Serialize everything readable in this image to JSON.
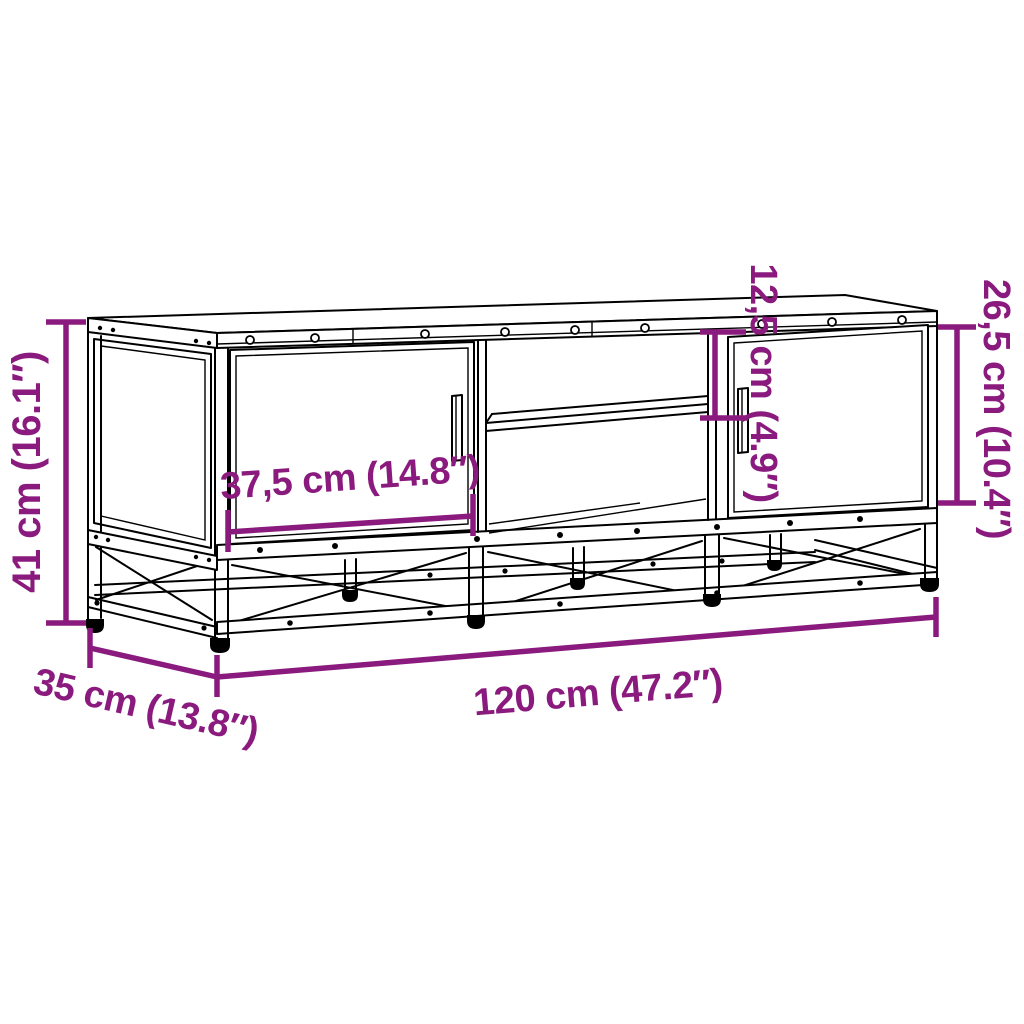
{
  "diagram": {
    "type": "furniture-dimension-diagram",
    "colors": {
      "dimension_accent": "#8A1A7D",
      "drawing_line": "#000000",
      "background": "#FFFFFF"
    },
    "dimensions": {
      "height": "41 cm (16.1″)",
      "depth": "35 cm (13.8″)",
      "width": "120 cm (47.2″)",
      "door_width": "37,5 cm (14.8″)",
      "compartment_height": "12,5 cm (4.9″)",
      "door_height": "26,5 cm (10.4″)"
    }
  }
}
